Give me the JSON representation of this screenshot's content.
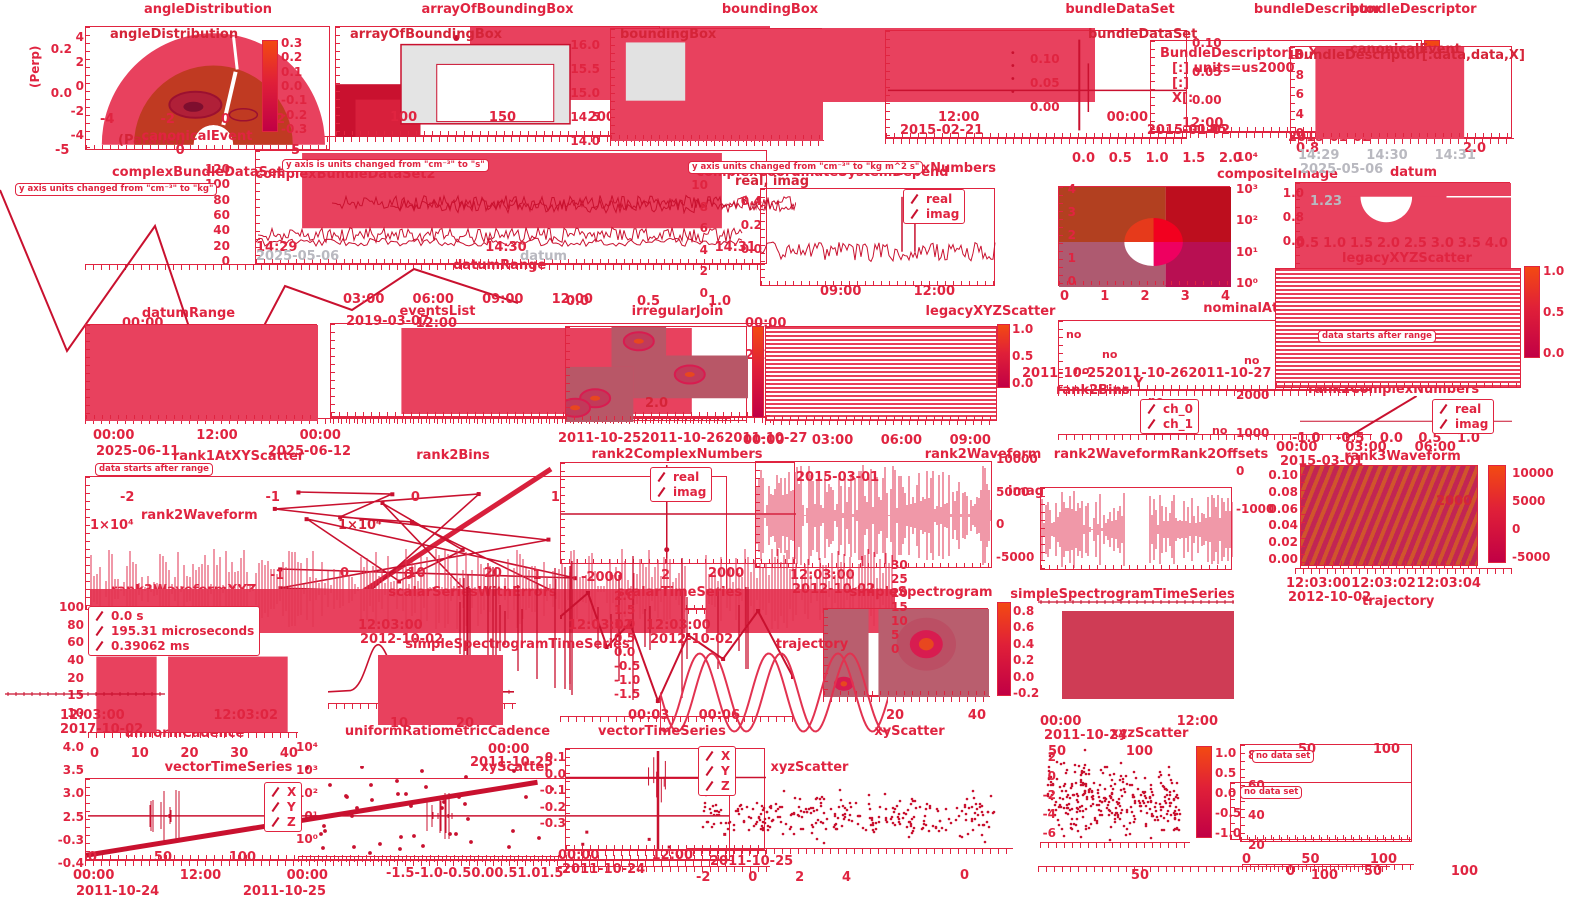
{
  "colors": {
    "accent": "#e02440",
    "fill": "#e8415e",
    "fill_dark": "#c9112f",
    "gray": "#b9b9c0",
    "colorbar_top": "#f34a12",
    "colorbar_bottom": "#c10045",
    "background": "#ffffff"
  },
  "chart_data": [
    {
      "id": "angleDistribution",
      "type": "heatmap",
      "title": "angleDistribution",
      "inner_title": "angleDistribution",
      "ylabel": "(Perp)",
      "xlabel": "(Parallel)",
      "yticks": [
        "4",
        "2",
        "0",
        "-2",
        "-4"
      ],
      "xticks": [
        "-4",
        "-2",
        "0",
        "2"
      ],
      "x2ticks": [
        "-5",
        "0",
        "5"
      ],
      "cbar_ticks": [
        "0.3",
        "0.2",
        "0.1",
        "0.0",
        "-0.1",
        "-0.2",
        "-0.3"
      ]
    },
    {
      "id": "arrayOfBoundingBox",
      "type": "area",
      "title": "arrayOfBoundingBox",
      "inner_title": "arrayOfBoundingBox",
      "xticks": [
        "100",
        "150",
        "200"
      ],
      "yticks": [
        "0.2",
        "0.0"
      ]
    },
    {
      "id": "boundingBox",
      "type": "area",
      "title": "boundingBox",
      "inner_title": "boundingBox",
      "yticks": [
        "16.0",
        "15.5",
        "15.0",
        "14.5",
        "14.0"
      ]
    },
    {
      "id": "bundleDataSet",
      "type": "line",
      "title": "bundleDataSet",
      "inner_title": "bundleDataSet",
      "yticks": [
        "0.10",
        "0.05",
        "0.00"
      ],
      "y2ticks": [
        "0.10",
        "0.05",
        "0.00",
        "-0.05"
      ],
      "times": [
        "12:00",
        "00:00"
      ],
      "dates": [
        "2015-02-21",
        "2015-01-02"
      ]
    },
    {
      "id": "bundleDescriptorA",
      "type": "table",
      "title": "bundleDescriptor",
      "text_lines": [
        "BundleDescriptor[..,X]",
        "[:] units=us2000",
        "[:]",
        "X[:"
      ],
      "times": [
        "12:00",
        "00:00"
      ],
      "dates": [
        "2015-01-02"
      ]
    },
    {
      "id": "bundleDescriptorB",
      "type": "area",
      "title": "bundleDescriptor",
      "inner_title": "BundleDescriptor[:data,data,X]",
      "inner_label": "canonicalEvent",
      "yticks": [
        "10",
        "8",
        "6",
        "4",
        "0"
      ],
      "xticks": [
        "0.8",
        "2.0"
      ]
    },
    {
      "id": "canonicalEvent",
      "type": "area",
      "title": "canonicalEvent"
    },
    {
      "id": "complexBundleDataSet",
      "type": "line",
      "title": "complexBundleDataSet",
      "warning": "y axis is units changed from \"cm⁻³\" to \"s\"",
      "yticks": [
        "120",
        "100",
        "80",
        "60",
        "40",
        "20",
        "0"
      ],
      "times": [
        "14:29",
        "14:30",
        "14:31"
      ]
    },
    {
      "id": "complexBundleDataSet2",
      "type": "line",
      "title": "complexBundleDataSet2",
      "warning": "y axis units changed from \"cm⁻³\" to \"kg\"",
      "times": [
        "00:00",
        "12:00"
      ],
      "dates": [
        "2016-12-21"
      ]
    },
    {
      "id": "complexCoordinateSystemDepend",
      "type": "line",
      "title": "complexCoordinateSystemDepend",
      "legend_note": "real, imag",
      "yticks": [
        "10",
        "8",
        "6",
        "4",
        "2",
        "0"
      ],
      "times": [
        "00:00"
      ],
      "dates": [
        "2016-12-22"
      ]
    },
    {
      "id": "complexNumbers",
      "type": "line",
      "title": "complexNumbers",
      "legend": [
        "real",
        "imag"
      ],
      "yticks": [
        "0.4",
        "0.2",
        "0.0"
      ],
      "times": [
        "09:00",
        "12:00"
      ]
    },
    {
      "id": "compositeImage",
      "type": "heatmap",
      "title": "compositeImage",
      "x2ticks": [
        "0.0",
        "0.5",
        "1.0",
        "1.5",
        "2.0"
      ],
      "yticks": [
        "4",
        "3",
        "2",
        "1",
        "0"
      ],
      "y2ticks": [
        "10⁴",
        "10³",
        "10²",
        "10¹",
        "10⁰"
      ],
      "xticks": [
        "0",
        "1",
        "2",
        "3",
        "4"
      ]
    },
    {
      "id": "datum",
      "type": "line",
      "title": "datum",
      "inner_label": "1.23",
      "times": [
        "14:29",
        "14:30",
        "14:31"
      ],
      "dates": [
        "2025-05-06"
      ],
      "yticks": [
        "1.0",
        "0.8",
        "0.6"
      ],
      "xticks": [
        "0.5",
        "1.0",
        "1.5",
        "2.0",
        "2.5",
        "3.0",
        "3.5",
        "4.0"
      ]
    },
    {
      "id": "datumRange",
      "type": "area",
      "title": "datumRange",
      "times": [
        "00:00",
        "12:00",
        "00:00"
      ],
      "dates": [
        "2025-06-11",
        "2025-06-12"
      ]
    },
    {
      "id": "eventsList",
      "type": "area",
      "title": "eventsList",
      "times": [
        "03:00",
        "06:00",
        "09:00",
        "12:00"
      ],
      "dates": [
        "2019-03-07"
      ]
    },
    {
      "id": "irregularJoin",
      "type": "heatmap",
      "title": "irregularJoin",
      "x2ticks": [
        "0.0",
        "0.5",
        "1.0"
      ],
      "inner_label": "2.0"
    },
    {
      "id": "legacyXYZScatter",
      "type": "heatmap",
      "title": "legacyXYZScatter",
      "cbar_ticks": [
        "1.0",
        "0.5",
        "0.0"
      ]
    },
    {
      "id": "nominalAtScatter",
      "type": "scatter",
      "title": "nominalAtScatter",
      "no_label": "no",
      "dates": [
        "2011-10-25",
        "2011-10-26",
        "2011-10-27"
      ]
    },
    {
      "id": "rank2Bins",
      "type": "line",
      "title": "rank2Bins",
      "inner_label": "1×10⁴"
    },
    {
      "id": "rank1AtXYScatter",
      "type": "scatter",
      "title": "rank1AtXYScatter",
      "warning": "data starts after range",
      "xticks": [
        "-2",
        "-1",
        "0",
        "1",
        "2"
      ]
    },
    {
      "id": "rank2ComplexNumbersA",
      "type": "line",
      "title": "rank2ComplexNumbers",
      "legend": [
        "real",
        "imag"
      ],
      "dates": [
        "2011-10-25",
        "2011-10-26",
        "2011-10-27"
      ]
    },
    {
      "id": "rank2Waveform",
      "type": "line",
      "title": "rank2Waveform",
      "times": [
        "00:00",
        "03:00",
        "06:00",
        "09:00"
      ],
      "dates": [
        "2015-03-01"
      ],
      "y2ticks": [
        "10000",
        "5000",
        "0",
        "-5000"
      ]
    },
    {
      "id": "rank2WaveformRank2Offsets",
      "type": "line",
      "title": "rank2WaveformRank2Offsets",
      "legend": [
        "ch_0",
        "ch_1"
      ],
      "y2ticks": [
        "2000",
        "1000",
        "0",
        "-1000"
      ]
    },
    {
      "id": "rank3Waveform",
      "type": "heatmap",
      "title": "rank3Waveform",
      "yticks": [
        "0.10",
        "0.08",
        "0.06",
        "0.04",
        "0.02",
        "0.00"
      ],
      "cbar_ticks": [
        "10000",
        "5000",
        "0",
        "-5000"
      ],
      "inner_label": "2000",
      "times": [
        "12:03:00",
        "12:03:02",
        "12:03:04"
      ],
      "dates": [
        "2012-10-02"
      ]
    },
    {
      "id": "rank3WaveformXYZ",
      "type": "line",
      "title": "rank3WaveformXYZ",
      "legend": [
        "0.0 s",
        "195.31 microseconds",
        "0.39062 ms"
      ],
      "xticks": [
        "-1",
        "0",
        "1",
        "2"
      ]
    },
    {
      "id": "scalarSeriesWithErrors",
      "type": "line",
      "title": "scalarSeriesWithErrors",
      "x2ticks": [
        "0",
        "10",
        "20"
      ]
    },
    {
      "id": "scalarTimeSeries",
      "type": "line",
      "title": "scalarTimeSeries",
      "yticks": [
        "2.0",
        "1.5",
        "1.0",
        "0.5",
        "0.0",
        "-0.5",
        "-1.0",
        "-1.5"
      ]
    },
    {
      "id": "simpleSpectrogram",
      "type": "heatmap",
      "title": "simpleSpectrogram",
      "times": [
        "12:03:00"
      ],
      "dates": [
        "2012-10-02"
      ],
      "cbar_ticks": [
        "0.8",
        "0.6",
        "0.4",
        "0.2",
        "0.0",
        "-0.2"
      ],
      "xticks": [
        "20",
        "40"
      ]
    },
    {
      "id": "simpleSpectrogramTimeSeriesA",
      "type": "line",
      "title": "simpleSpectrogramTimeSeries",
      "xticks": [
        "10",
        "20"
      ]
    },
    {
      "id": "simpleSpectrogramTimeSeriesB",
      "type": "line",
      "title": "simpleSpectrogramTimeSeries",
      "times": [
        "00:00",
        "12:00"
      ],
      "dates": [
        "2011-10-24"
      ]
    },
    {
      "id": "trajectory",
      "type": "line",
      "title": "trajectory",
      "times": [
        "00:03",
        "00:06"
      ],
      "yticks": [
        "30",
        "25",
        "20",
        "15",
        "10",
        "5",
        "0"
      ]
    },
    {
      "id": "uniformCadence",
      "type": "area",
      "title": "uniformCadence",
      "times": [
        "12:03:00",
        "12:03:02"
      ],
      "dates": [
        "2017-10-02"
      ],
      "yticks": [
        "100",
        "80",
        "60",
        "40",
        "20",
        "15",
        "10"
      ]
    },
    {
      "id": "uniformRatiometricCadence",
      "type": "line",
      "title": "uniformRatiometricCadence",
      "y2ticks": [
        "10⁴",
        "10³",
        "10²",
        "10¹",
        "10⁰"
      ]
    },
    {
      "id": "vectorTimeSeries",
      "type": "line",
      "title": "vectorTimeSeries",
      "legend": [
        "X",
        "Y",
        "Z"
      ],
      "x2ticks": [
        "0",
        "10",
        "20",
        "30",
        "40"
      ],
      "yticks": [
        "4.0",
        "3.5",
        "3.0",
        "2.5",
        "-0.3",
        "-0.4"
      ],
      "xticks": [
        "0",
        "50",
        "100"
      ],
      "times": [
        "00:00",
        "12:00",
        "00:00"
      ],
      "dates": [
        "2011-10-24",
        "2011-10-25"
      ]
    },
    {
      "id": "xyScatterA",
      "type": "scatter",
      "title": "xyScatter",
      "xticks": [
        "-1.5",
        "-1.0",
        "-0.5",
        "0.0",
        "0.5",
        "1.0",
        "1.5"
      ]
    },
    {
      "id": "xyScatterB",
      "type": "scatter",
      "title": "xyScatter",
      "yticks": [
        "0.1",
        "0.0",
        "-0.1",
        "-0.2",
        "-0.3"
      ],
      "times": [
        "00:00",
        "12:00"
      ],
      "dates": [
        "2011-10-24"
      ]
    },
    {
      "id": "xyzScatterA",
      "type": "scatter",
      "title": "xyzScatter",
      "legend": [
        "X",
        "Y",
        "Z"
      ],
      "xticks": [
        "-2",
        "0",
        "2",
        "4"
      ],
      "dates": [
        "2011-10-25"
      ]
    },
    {
      "id": "xyzScatterB",
      "type": "scatter",
      "title": "xyzScatter",
      "x2ticks": [
        "50",
        "100"
      ],
      "yticks": [
        "2",
        "0",
        "-2",
        "-4",
        "-6"
      ],
      "cbar_ticks": [
        "1.0",
        "0.5",
        "0.0",
        "-0.5",
        "-1.0"
      ],
      "xticks": [
        "0",
        "50",
        "100"
      ]
    },
    {
      "id": "noDataSetA",
      "type": "table",
      "warning": "no data set",
      "x2ticks": [
        "50",
        "100"
      ],
      "yticks": [
        "80",
        "60",
        "40",
        "20"
      ],
      "xticks": [
        "0",
        "50",
        "100"
      ]
    },
    {
      "id": "noDataSetB",
      "type": "table",
      "warning": "no data set",
      "xticks": [
        "0",
        "50",
        "100"
      ]
    },
    {
      "id": "rank2ComplexNumbersB",
      "type": "line",
      "title": "rank2ComplexNumbers",
      "legend": [
        "real",
        "imag"
      ],
      "xticks": [
        "-1.0",
        "-0.5",
        "0.0",
        "0.5",
        "1.0"
      ]
    },
    {
      "id": "rank1AlongTrajectory",
      "type": "heatmap",
      "title": "rank1AlongTrajectory",
      "warning": "data starts after range",
      "times": [
        "00:00",
        "03:00",
        "06:00"
      ],
      "dates": [
        "2015-03-01"
      ],
      "cbar_ticks": [
        "1.0",
        "0.5",
        "0.0"
      ]
    }
  ],
  "stray_labels": [
    {
      "text": "datum"
    },
    {
      "text": "2025-05-06"
    },
    {
      "text": "legacyXYZScatter"
    },
    {
      "text": "rank2Bins"
    },
    {
      "text": "Y"
    },
    {
      "text": "rank2Waveform"
    },
    {
      "text": "trajectory"
    },
    {
      "text": "vectorTimeSeries"
    },
    {
      "text": "12:03:00"
    },
    {
      "text": "12:03:02"
    },
    {
      "text": "12:03:00"
    },
    {
      "text": "2012-10-02"
    },
    {
      "text": "2012-10-02"
    },
    {
      "text": "00:00"
    },
    {
      "text": "2011-10-25"
    },
    {
      "text": "-2000"
    },
    {
      "text": "2000"
    },
    {
      "text": "y axis units changed from \"cm⁻³\" to \"kg m^2 s\""
    },
    {
      "text": "imag"
    },
    {
      "text": "1×10⁴"
    },
    {
      "text": "datumRange"
    }
  ]
}
